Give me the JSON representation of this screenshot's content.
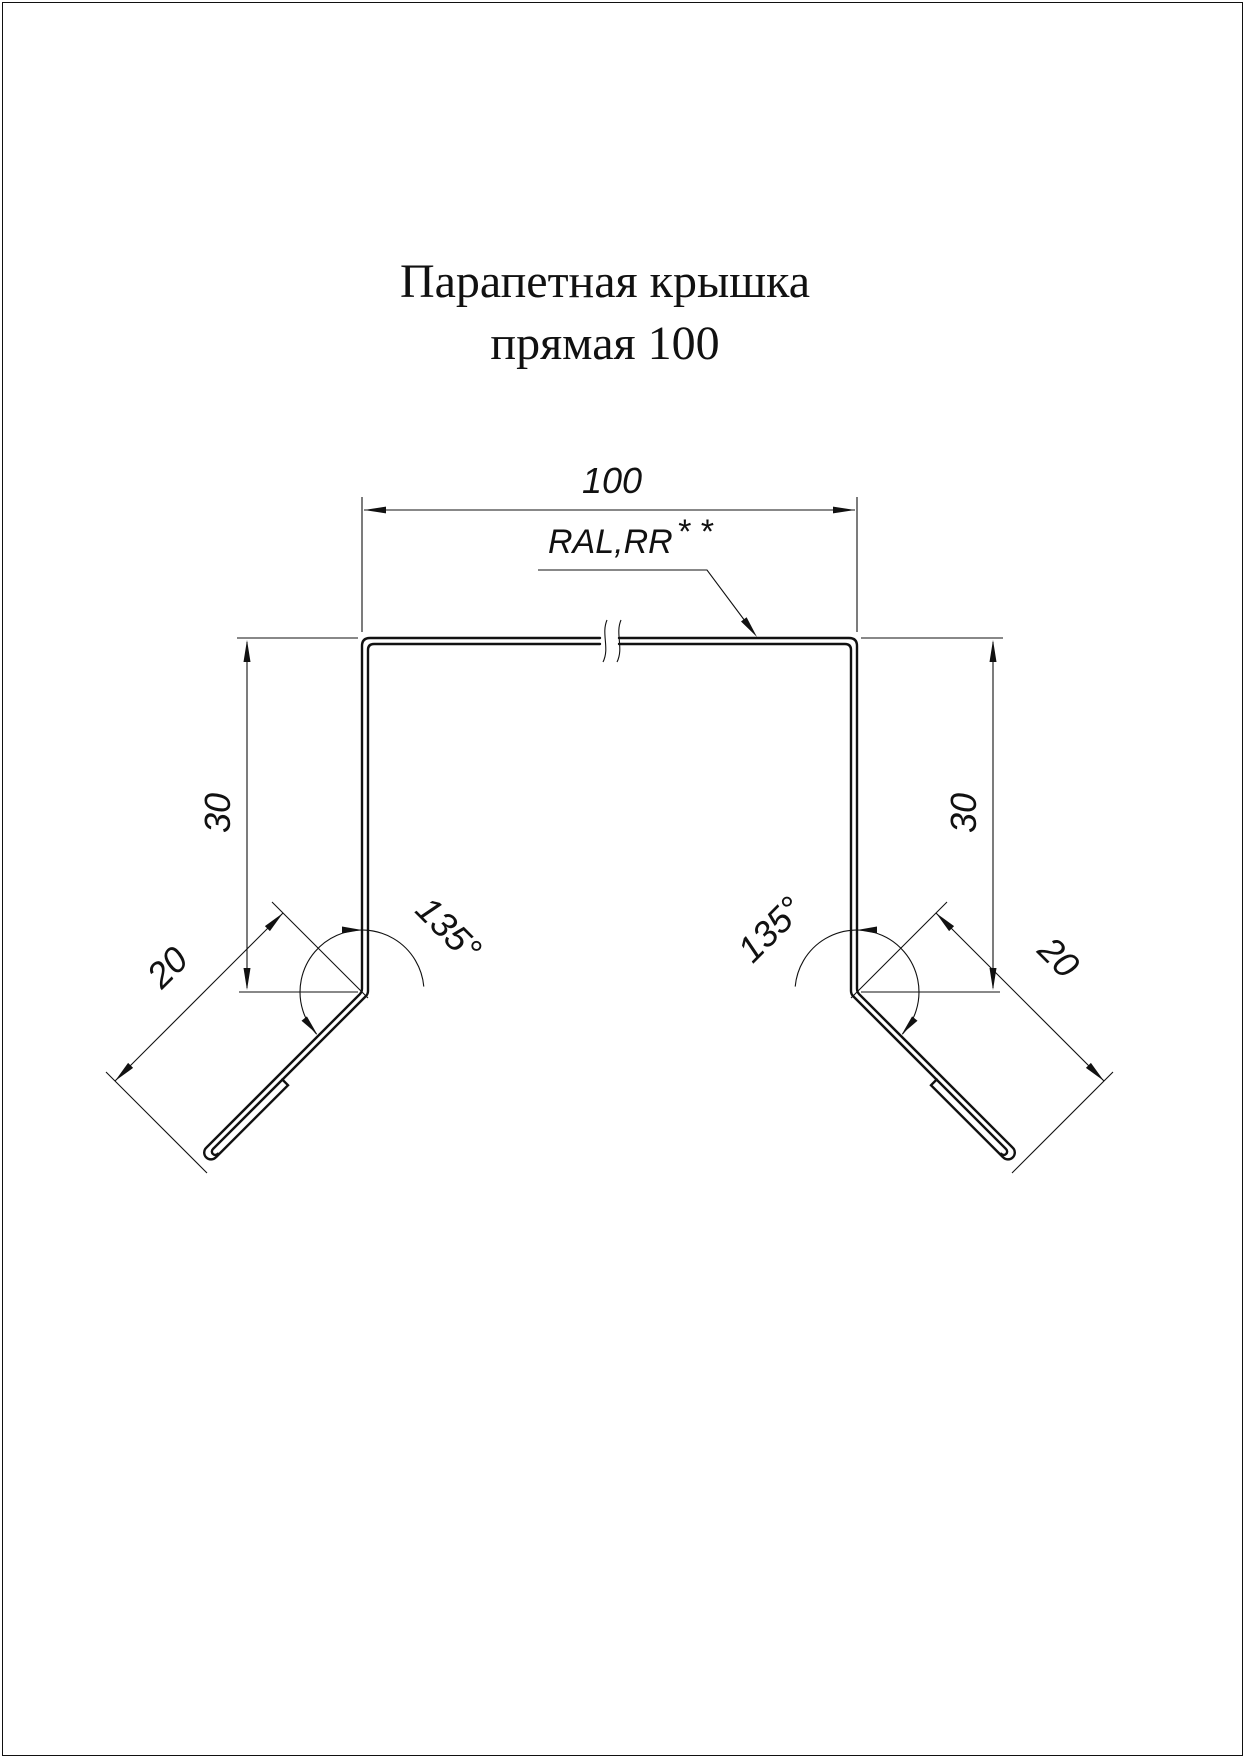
{
  "title": {
    "line1": "Парапетная крышка",
    "line2": "прямая 100"
  },
  "labels": {
    "top_width": "100",
    "coating": "RAL,RR",
    "coating_stars": "* *",
    "side_height_left": "30",
    "side_height_right": "30",
    "drip_length_left": "20",
    "drip_length_right": "20",
    "angle_left": "135°",
    "angle_right": "135°"
  },
  "colors": {
    "line": "#111111",
    "background": "#ffffff"
  }
}
